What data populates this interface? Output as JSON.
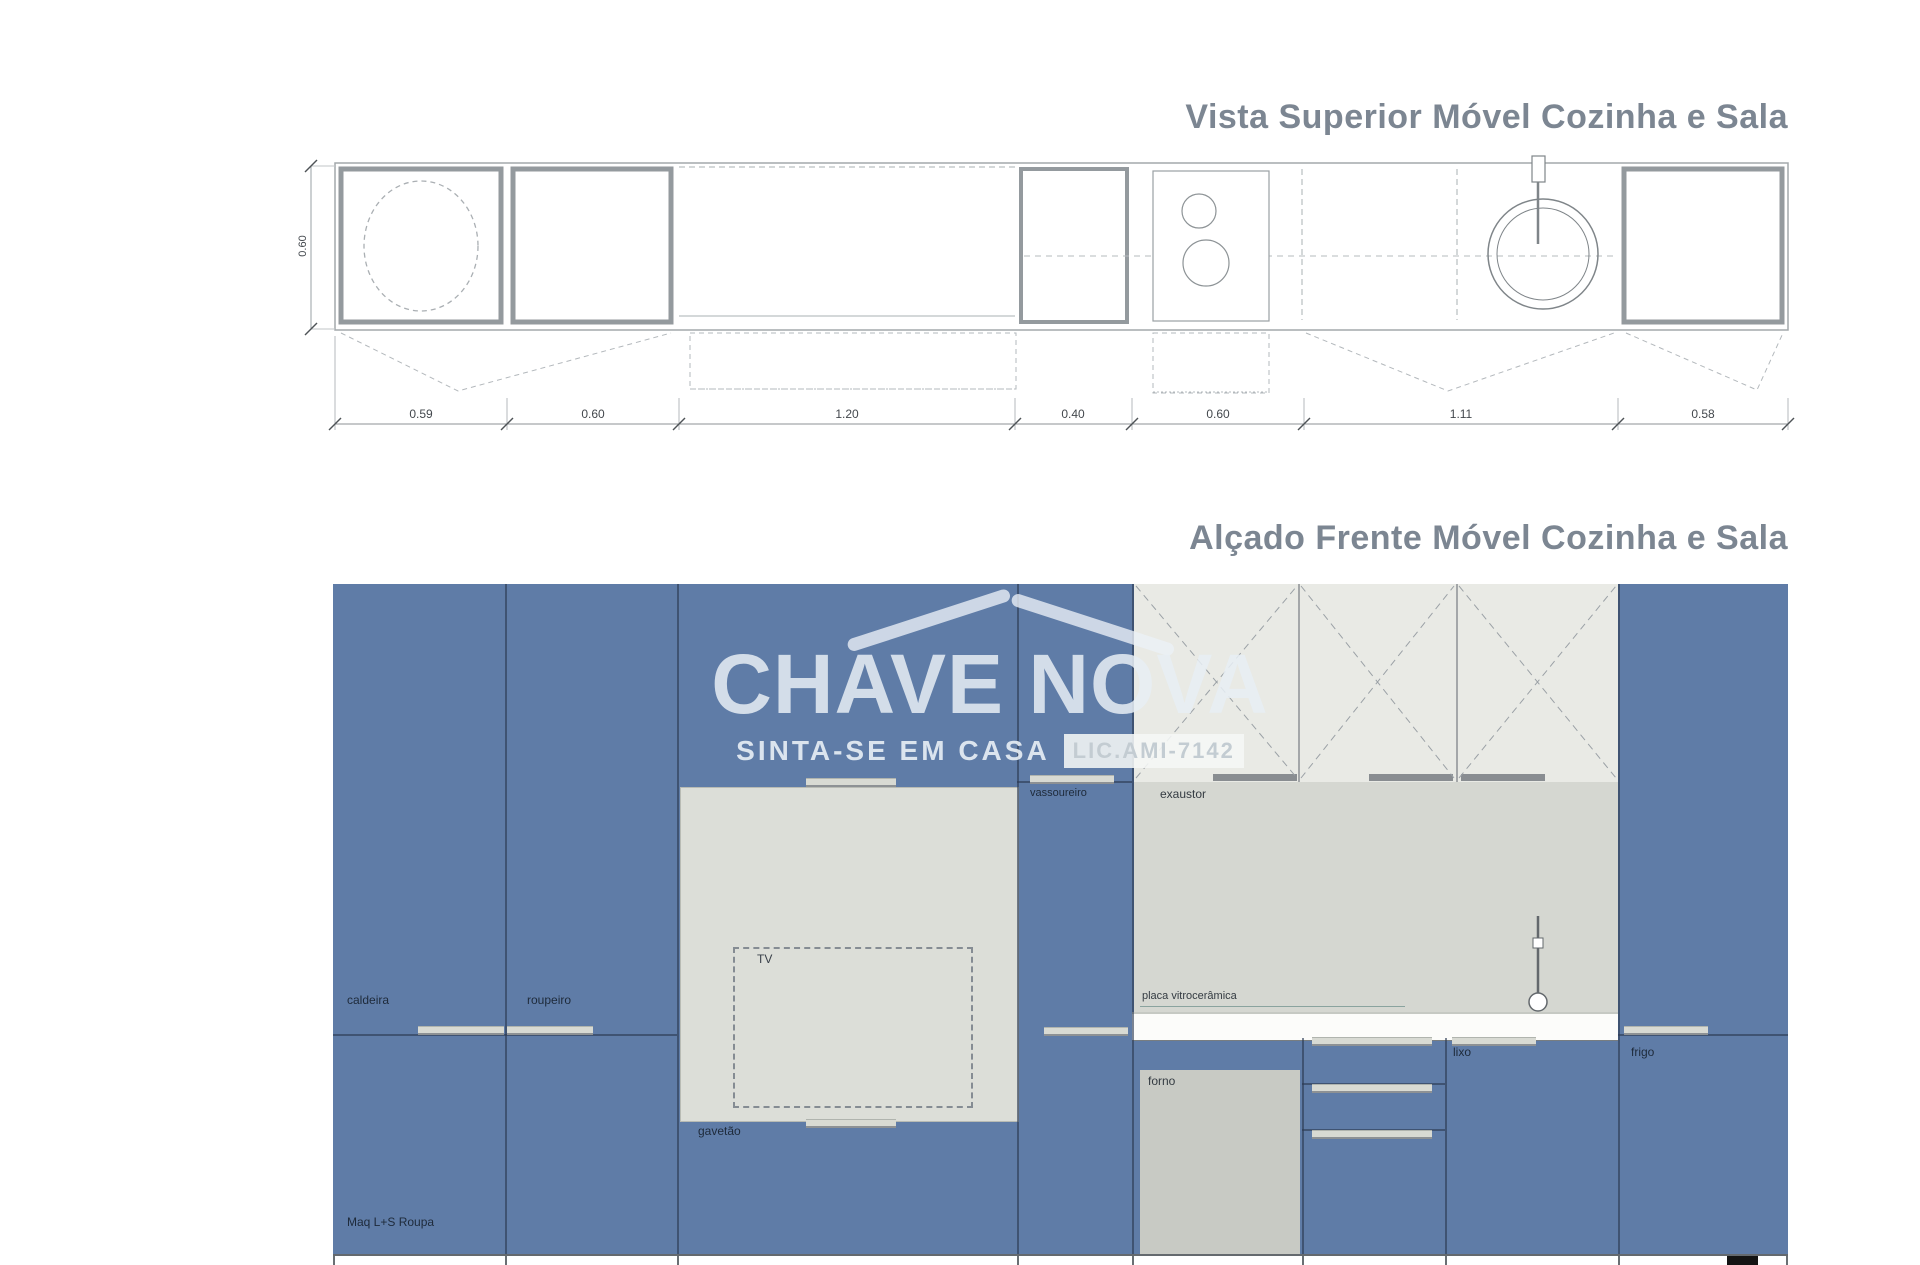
{
  "plan": {
    "title": "Vista Superior Móvel Cozinha e Sala",
    "depth_dim": "0.60",
    "width_dims": [
      "0.59",
      "0.60",
      "1.20",
      "0.40",
      "0.60",
      "1.11",
      "0.58"
    ]
  },
  "elevation": {
    "title": "Alçado Frente Móvel Cozinha e Sala",
    "labels": {
      "caldeira": "caldeira",
      "roupeiro": "roupeiro",
      "maq_roupa": "Maq L+S Roupa",
      "tv": "TV",
      "gavetao": "gavetão",
      "vassoureiro": "vassoureiro",
      "exaustor": "exaustor",
      "placa": "placa vitrocerâmica",
      "forno": "forno",
      "lixo": "lixo",
      "frigo": "frigo"
    }
  },
  "watermark": {
    "brand": "CHAVE NOVA",
    "tagline": "SINTA-SE EM CASA",
    "license": "LIC.AMI-7142"
  },
  "colors": {
    "cabinet_blue": "#5f7ca7",
    "niche_gray": "#dcded8",
    "upper_cabinet_gray": "#e9eae5",
    "backsplash_gray": "#d5d7d1",
    "oven_gray": "#c8cac4",
    "title_gray": "#7c8692",
    "watermark_light": "#e7eef5"
  }
}
